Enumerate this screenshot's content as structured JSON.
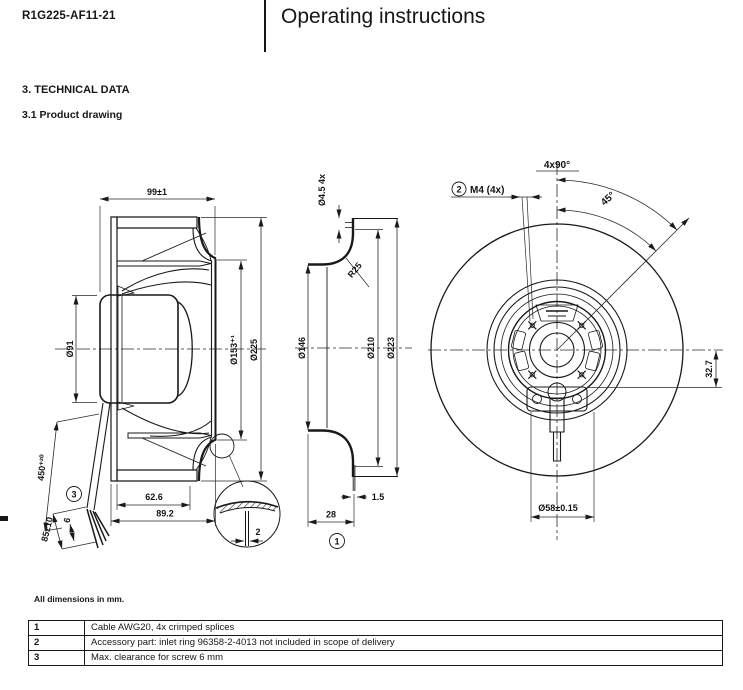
{
  "header": {
    "model": "R1G225-AF11-21",
    "title": "Operating instructions"
  },
  "sections": {
    "heading": "3. TECHNICAL DATA",
    "subheading": "3.1 Product drawing"
  },
  "drawing": {
    "side_view": {
      "depth": "99±1",
      "motor_diameter": "Ø91",
      "inlet_diameter": "Ø153⁺¹",
      "outer_diameter": "Ø225",
      "hub_depth": "62.6",
      "housing_depth": "89.2",
      "cable_length": "450⁺²⁰",
      "splice_length": "85±10",
      "strip_length": "6",
      "edge_thickness": "2",
      "callout": "3"
    },
    "inlet_ring_view": {
      "holes": "Ø4.5 4x",
      "radius": "R25",
      "inner_diameter": "Ø146",
      "bolt_circle": "Ø210",
      "outer_diameter": "Ø223",
      "sheet_thickness": "1.5",
      "depth": "28",
      "callout": "1"
    },
    "front_view": {
      "hole_pattern": "4x90°",
      "angle": "45°",
      "thread": "M4 (4x)",
      "thread_callout": "2",
      "axis_offset": "32.7",
      "hub_diameter": "Ø58±0.15"
    }
  },
  "notes": {
    "dimensions_note": "All dimensions in mm."
  },
  "legend": {
    "rows": [
      {
        "id": "1",
        "description": "Cable AWG20, 4x crimped splices"
      },
      {
        "id": "2",
        "description": "Accessory part: inlet ring 96358-2-4013 not included in scope of delivery"
      },
      {
        "id": "3",
        "description": "Max. clearance for screw 6 mm"
      }
    ]
  }
}
